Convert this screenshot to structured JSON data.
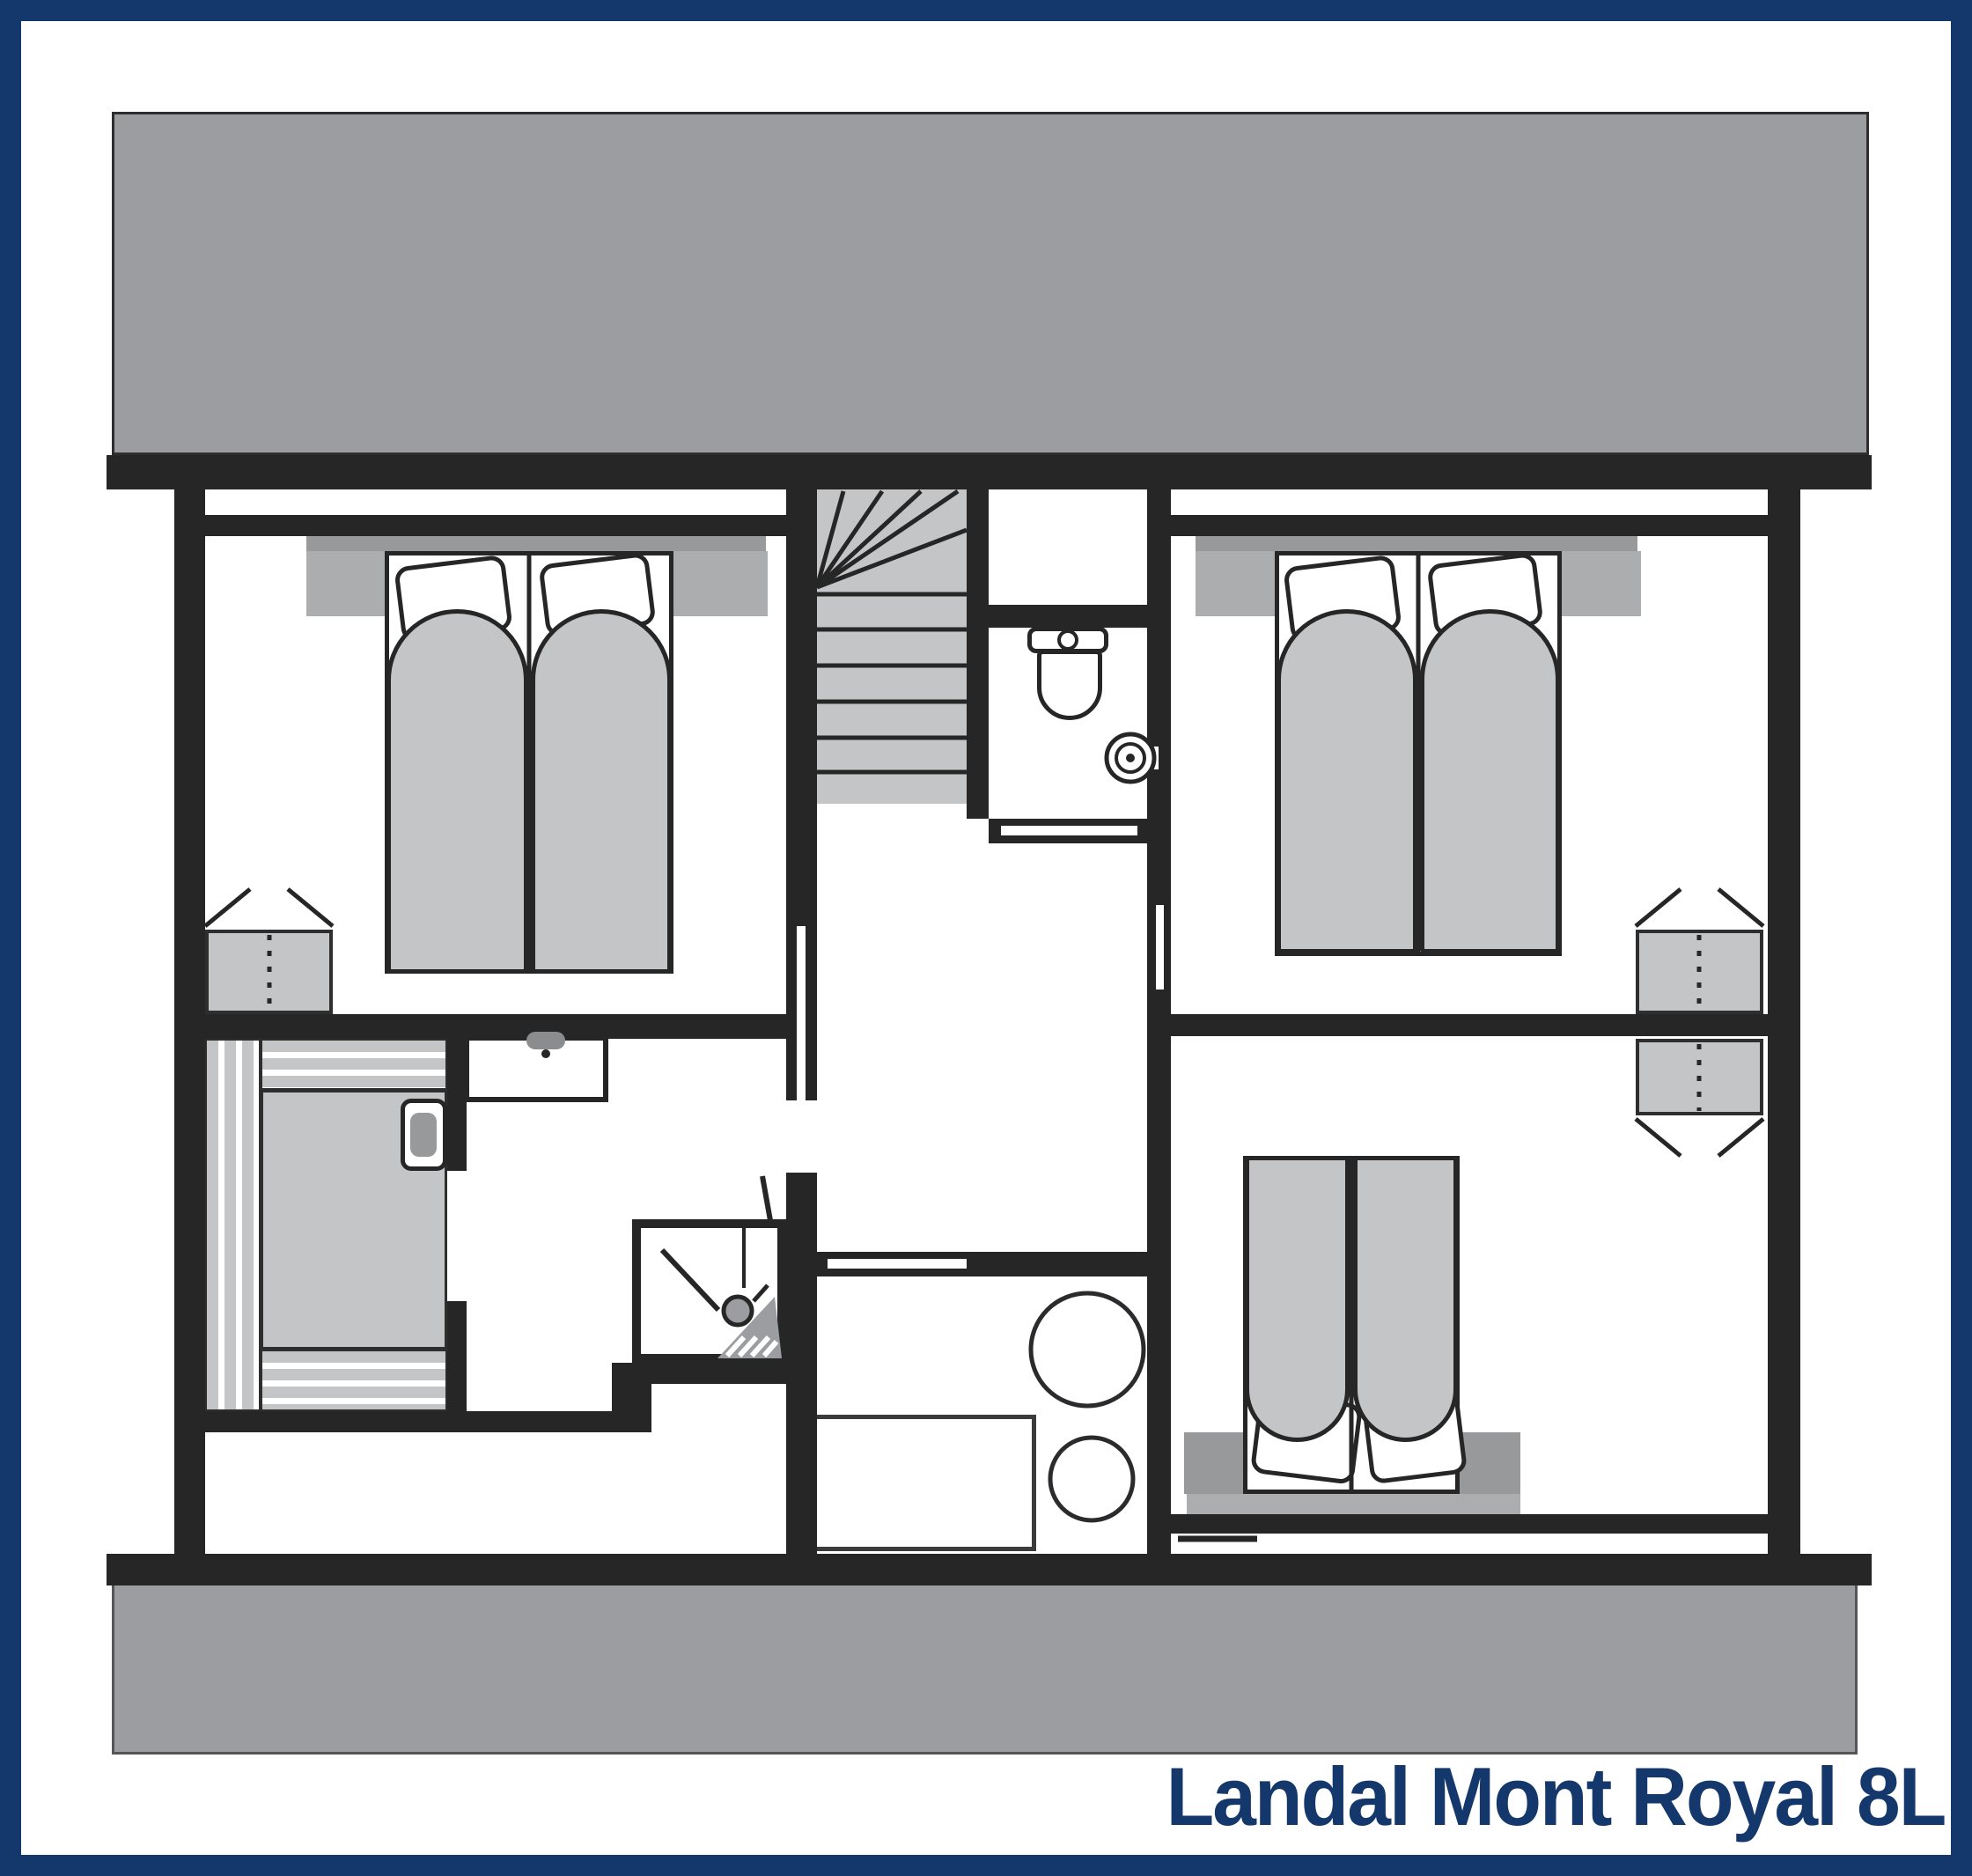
{
  "title": {
    "label": "Landal Mont Royal 8L"
  },
  "colors": {
    "navy": "#14386b",
    "wall": "#262626",
    "roof": "#9b9da1",
    "furn": "#c4c5c7",
    "band": "#abadaf",
    "dark": "#97999b",
    "edge": "#55565a",
    "line": "#2e2e2e"
  },
  "symbols": {
    "roof": "roof-band",
    "terrace": "terrace-band",
    "stairs": "winder-staircase-icon",
    "wc": "toilet-icon",
    "wc_basin": "round-washbasin-icon",
    "basin": "washbasin-icon",
    "shower": "shower-icon",
    "sauna": "sauna-bench-stripes-icon",
    "sauna_door": "sauna-door-handle-icon",
    "wardrobes": "open-wardrobe-icon",
    "beds": "double-bed-icon",
    "boiler": "boiler-circles-icon",
    "worktop": "worktop-rect-icon"
  }
}
